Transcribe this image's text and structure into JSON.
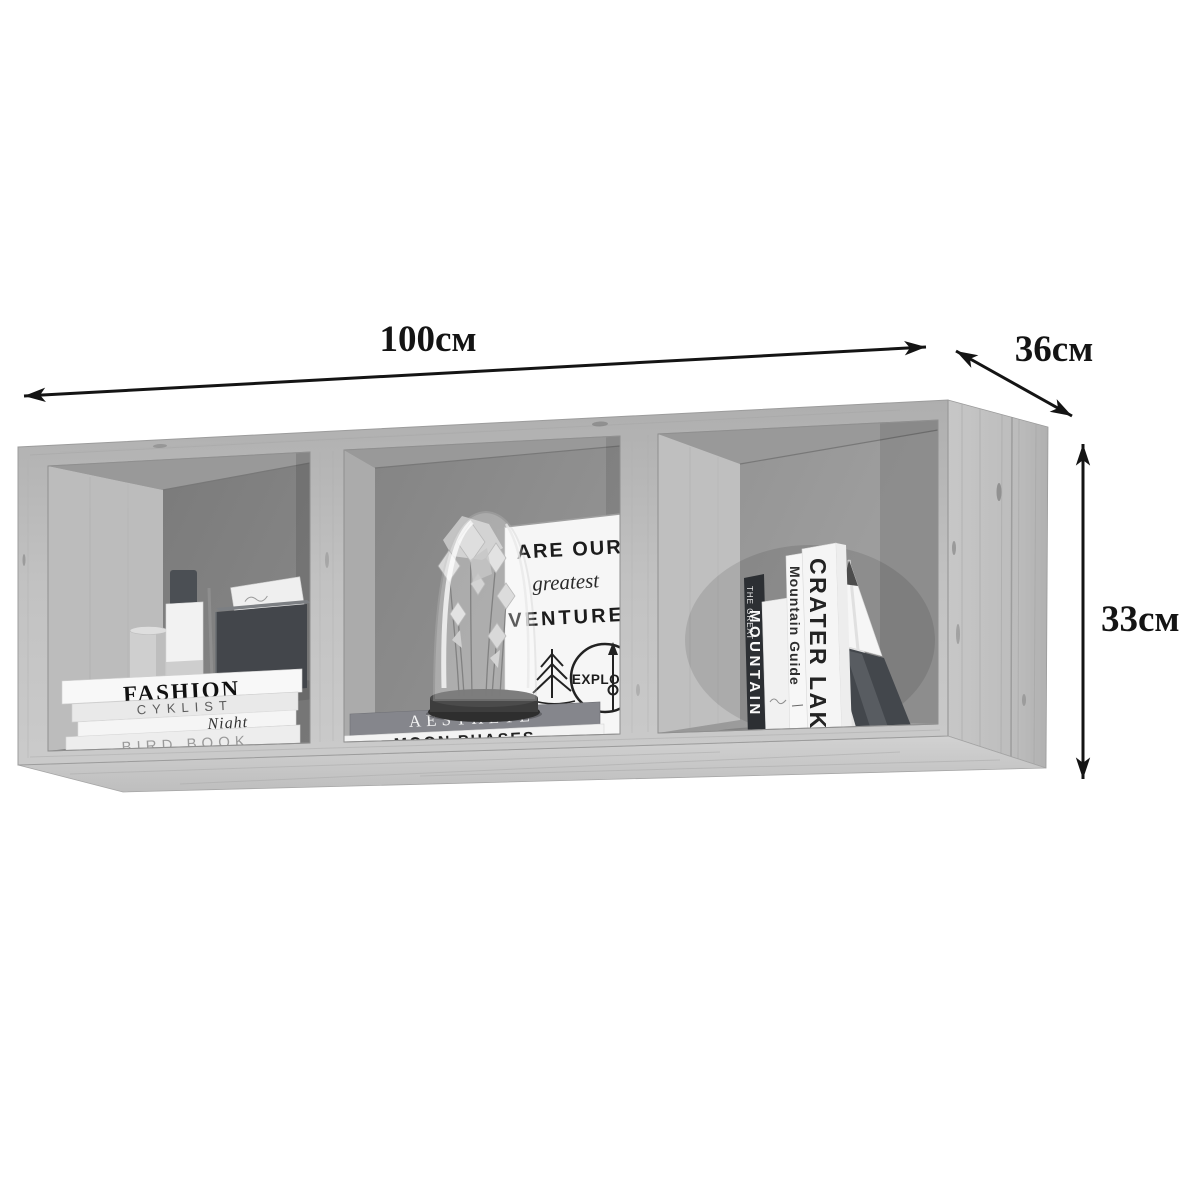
{
  "page": {
    "background_color": "#ffffff"
  },
  "dimensions": {
    "width_label": "100см",
    "depth_label": "36см",
    "height_label": "33см"
  },
  "shelf": {
    "description": "wall-mounted wood shelf with three open compartments, decorated with books and objects",
    "compartments": {
      "left": {
        "stacked_books": {
          "top": "FASHION",
          "second": "CYKLIST",
          "third": "Night",
          "bottom": "BIRD BOOK"
        },
        "items": [
          "paper-roll",
          "spray-bottle",
          "incense-stick",
          "dark-gift-box",
          "greeting-card"
        ]
      },
      "middle": {
        "poster": {
          "line1": "ARE OUR",
          "line2": "greatest",
          "line3": "VENTURE",
          "badge_text": "EXPLO"
        },
        "stacked_books": {
          "top": "AESTHETE",
          "bottom": "MOON PHASES"
        },
        "items": [
          "glass-dome-with-paper-flowers"
        ]
      },
      "right": {
        "standing_books": {
          "first_top": "THE GREAT",
          "first_main": "MOUNTAIN",
          "second": "Mountain Guide",
          "third": "CRATER LAKE"
        },
        "items": [
          "mountain-bookend",
          "giant-pencil"
        ]
      }
    }
  },
  "colors": {
    "arrow": "#141414",
    "wood_light": "#c6c6c6",
    "interior_back": "#858585",
    "dark_box": "#43464b",
    "dark_book_spine": "#2c2f33"
  }
}
